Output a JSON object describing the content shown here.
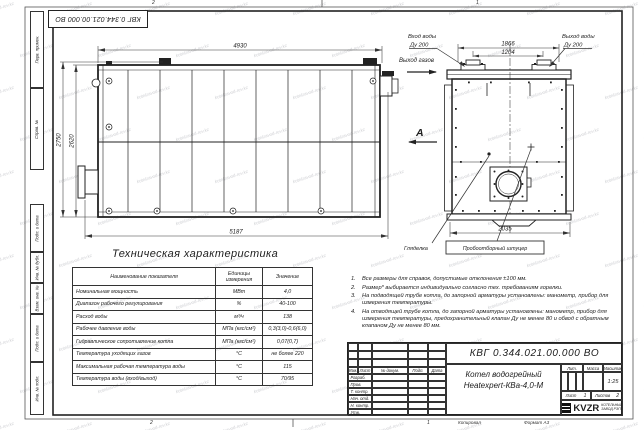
{
  "watermark_text": "kotelzavod-rev.kz",
  "stamp_top": {
    "designation": "КВГ 0.344.021.00.000 ВО"
  },
  "margins": {
    "stamps": [
      "Перв. примен.",
      "Справ. №",
      "Подп. и дата",
      "Инв. № дубл.",
      "Взам. инв. №",
      "Подп. и дата",
      "Инв. № подл."
    ],
    "zone_top_left": "2",
    "zone_top_right": "1",
    "zone_bottom_left": "2",
    "zone_bottom_right": "1",
    "copy_label": "Копировал",
    "format_label": "Формат А3"
  },
  "side_view": {
    "dim_width_top": "4930",
    "dim_width_bottom": "5187",
    "dim_height_outer": "2750",
    "dim_height_inner": "2620",
    "gas_outlet_label": "Выход газов",
    "view_arrow_label": "А"
  },
  "rear_view": {
    "water_inlet_label": "Вход воды",
    "water_inlet_dn": "Ду 200",
    "water_outlet_label": "Выход воды",
    "water_outlet_dn": "Ду 200",
    "dim_flange_outer": "1866",
    "dim_flange_centers": "1204",
    "dim_width": "2035",
    "sight_glass_label": "Гляделка",
    "sampling_label": "Пробоотборный штуцер"
  },
  "spec_table": {
    "title": "Техническая характеристика",
    "headers": [
      "Наименование показателя",
      "Единицы измерения",
      "Значение"
    ],
    "rows": [
      {
        "name": "Номинальная мощность",
        "units": "МВт",
        "value": "4,0"
      },
      {
        "name": "Диапазон рабочего регулирования",
        "units": "%",
        "value": "40-100"
      },
      {
        "name": "Расход воды",
        "units": "м³/ч",
        "value": "138"
      },
      {
        "name": "Рабочее давление воды",
        "units": "МПа (кгс/см²)",
        "value": "0,3(3,0)-0,6(6,0)"
      },
      {
        "name": "Гидравлическое сопротивление котла",
        "units": "МПа (кгс/см²)",
        "value": "0,07(0,7)"
      },
      {
        "name": "Температура уходящих газов",
        "units": "°С",
        "value": "не более 220"
      },
      {
        "name": "Максимальная рабочая температура воды",
        "units": "°С",
        "value": "115"
      },
      {
        "name": "Температура воды (вход/выход)",
        "units": "°С",
        "value": "70/95"
      }
    ]
  },
  "notes": {
    "items": [
      {
        "n": "1.",
        "text": "Все размеры для справок, допустимые отклонения ±100 мм."
      },
      {
        "n": "2.",
        "text": "Размер* выбирается индивидуально согласно тех. требованиям горелки."
      },
      {
        "n": "3.",
        "text": "На подводящей трубе котла, до запорной арматуры установлены: манометр, прибор для измерения температуры."
      },
      {
        "n": "4.",
        "text": "На отводящей трубе котла, до запорной арматуры установлены: манометр, прибор для измерения температуры, предохранительный клапан Ду не менее 80 и обвод с обратным клапаном Ду не менее 80 мм."
      }
    ]
  },
  "title_block": {
    "designation": "КВГ 0.344.021.00.000 ВО",
    "product_name_line1": "Котел водогрейный",
    "product_name_line2": "Heatexpert-КВа-4,0-М",
    "header_cols": {
      "izm": "Изм.",
      "list": "Лист",
      "doc": "№ докум.",
      "sign": "Подп.",
      "date": "Дата"
    },
    "signature_rows": [
      "Разраб.",
      "Пров.",
      "Т. контр.",
      "Нач. отд.",
      "Н. контр.",
      "Утв."
    ],
    "lit_label": "Лит.",
    "mass_label": "Масса",
    "scale_label": "Масштаб",
    "scale_value": "1:25",
    "sheet_label": "Лист",
    "sheet_value": "1",
    "sheets_label": "Листов",
    "sheets_value": "2",
    "company": {
      "logo": "KVZR",
      "line1": "КОТЕЛЬНЫЙ",
      "line2": "ЗАВОД РЭП"
    }
  }
}
